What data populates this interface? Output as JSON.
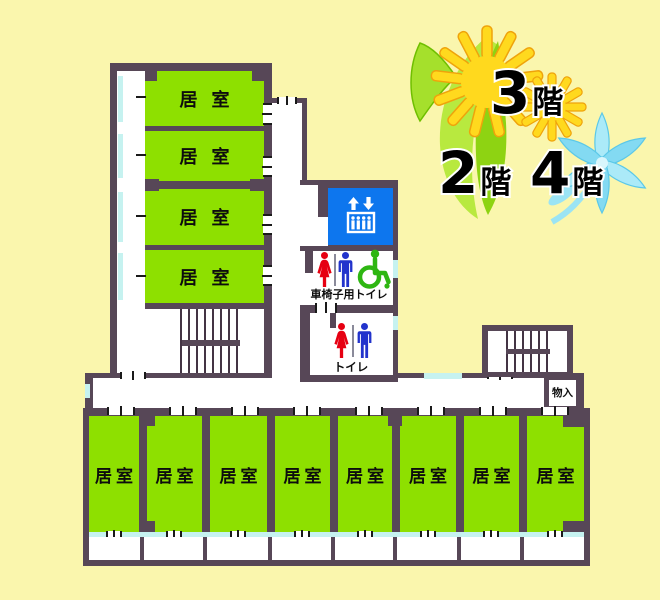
{
  "floors": {
    "f2": {
      "num": "2",
      "suffix": "階"
    },
    "f3": {
      "num": "3",
      "suffix": "階"
    },
    "f4": {
      "num": "4",
      "suffix": "階"
    }
  },
  "left_wing": {
    "rooms": [
      {
        "label": "居室"
      },
      {
        "label": "居室"
      },
      {
        "label": "居室"
      },
      {
        "label": "居室"
      }
    ]
  },
  "bottom_wing": {
    "rooms": [
      {
        "label": "居室"
      },
      {
        "label": "居室"
      },
      {
        "label": "居室"
      },
      {
        "label": "居室"
      },
      {
        "label": "居室"
      },
      {
        "label": "居室"
      },
      {
        "label": "居室"
      },
      {
        "label": "居室"
      }
    ]
  },
  "facilities": {
    "toilet": {
      "label": "トイレ"
    },
    "wheelchair_toilet": {
      "label": "車椅子用トイレ"
    },
    "storage": {
      "label": "物入"
    }
  },
  "icons": {
    "elevator": "elevator-icon",
    "woman": "woman-icon",
    "man": "man-icon",
    "wheelchair": "wheelchair-icon",
    "stairs": "stair-treads"
  },
  "palette": {
    "background": "#FAF6AD",
    "wall": "#574757",
    "room_green": "#8EE000",
    "window_cyan": "#C6F2F0",
    "elevator_blue": "#0D76EE",
    "woman_red": "#E60012",
    "man_blue": "#2233CC",
    "wheelchair_green": "#2EB612",
    "daisy_yellow": "#FFD91E",
    "sprout_green": "#93D615",
    "lily_blue": "#A9E9F7"
  }
}
